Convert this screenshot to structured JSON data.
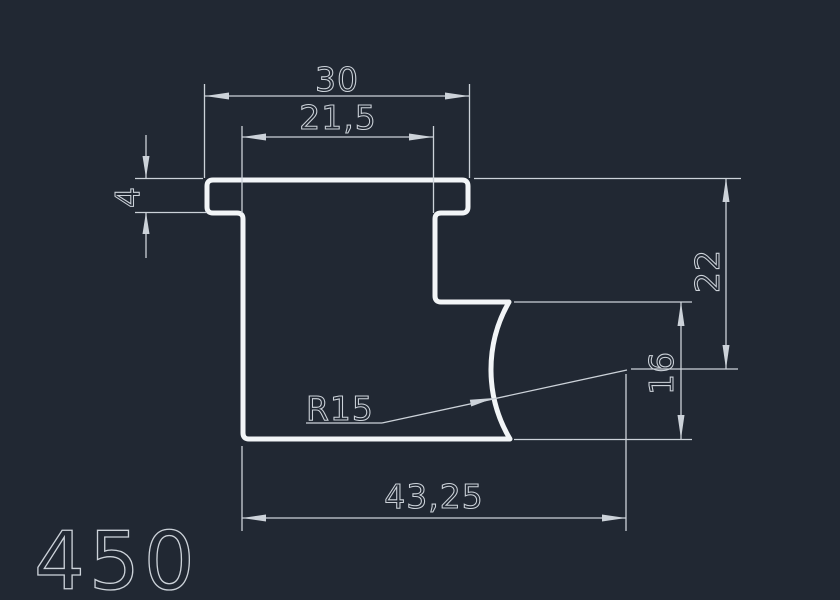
{
  "drawing": {
    "part_label": "450",
    "colors": {
      "background": "#212833",
      "geometry": "#f2f5f7",
      "dimension": "#ccd2d9"
    },
    "dimensions": {
      "top_width": "30",
      "top_inner_width": "21,5",
      "flange_thickness": "4",
      "height_right": "22",
      "height_step": "16",
      "bottom_width": "43,25",
      "fillet_radius": "R15"
    }
  }
}
